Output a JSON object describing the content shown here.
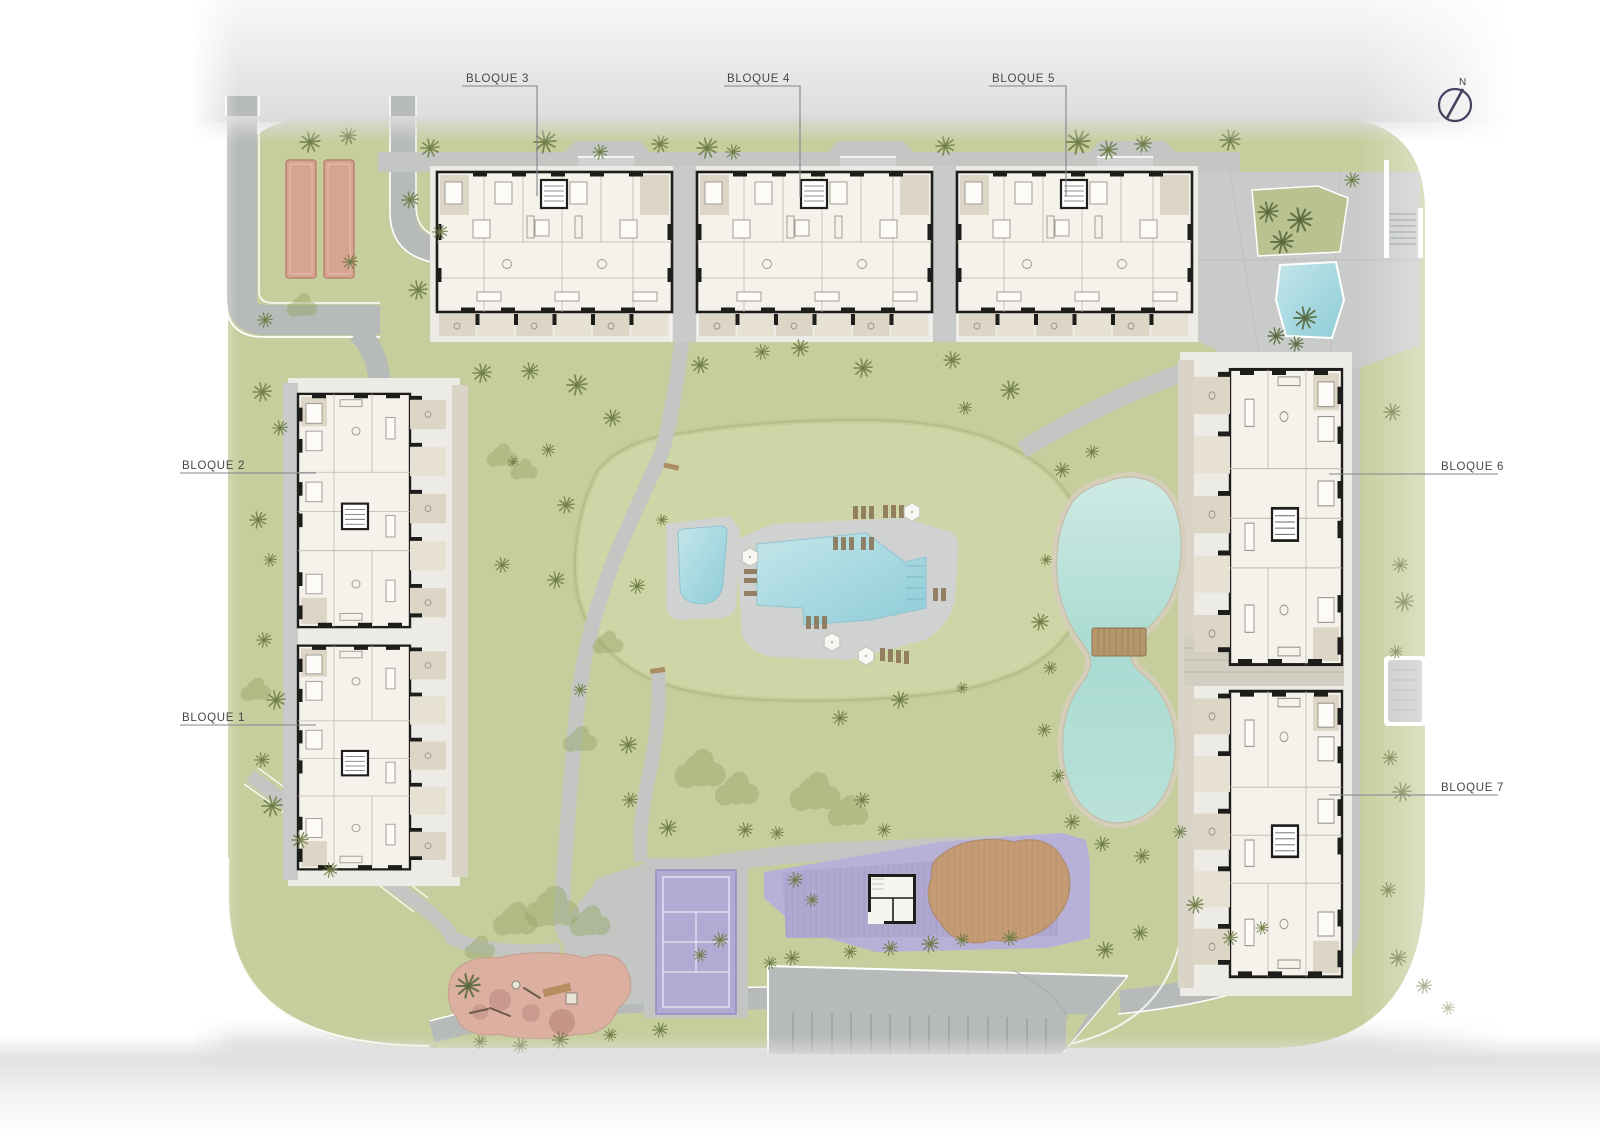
{
  "meta": {
    "kind": "architectural-site-plan"
  },
  "labels": {
    "blocks": [
      {
        "id": "bloque-1",
        "label": "BLOQUE 1"
      },
      {
        "id": "bloque-2",
        "label": "BLOQUE 2"
      },
      {
        "id": "bloque-3",
        "label": "BLOQUE 3"
      },
      {
        "id": "bloque-4",
        "label": "BLOQUE 4"
      },
      {
        "id": "bloque-5",
        "label": "BLOQUE 5"
      },
      {
        "id": "bloque-6",
        "label": "BLOQUE 6"
      },
      {
        "id": "bloque-7",
        "label": "BLOQUE 7"
      }
    ],
    "compass": "N"
  },
  "palette": {
    "grass": "#c7ce9e",
    "mound": "#ced5a6",
    "road": "#b6bab8",
    "walk": "#c3c6c3",
    "plaza": "#c8cbc9",
    "backing": "#edebe5",
    "gravel": "#d9d4c7",
    "building": "#f5f2ec",
    "wall": "#1d1d1b",
    "terrace": "#ddd5c5",
    "terrace2": "#e7e1d3",
    "deck": "#cfd2d0",
    "pool": "#a9d9e1",
    "lake": "#a8d8cf",
    "sand": "#d6cebb",
    "purple": "#b8b1d7",
    "purple-deck": "#b0a8d0",
    "plank": "#9c94c2",
    "playground": "#dcb0a0",
    "court-salmon": "#d8a492",
    "lounger": "#8b7658",
    "bridge": "#b5976b",
    "tree": "#6d7b45",
    "bush": "#97a567",
    "label": "#47474b",
    "leader": "#83838f",
    "compass": "#46425f",
    "band": "#e4e4e4"
  }
}
